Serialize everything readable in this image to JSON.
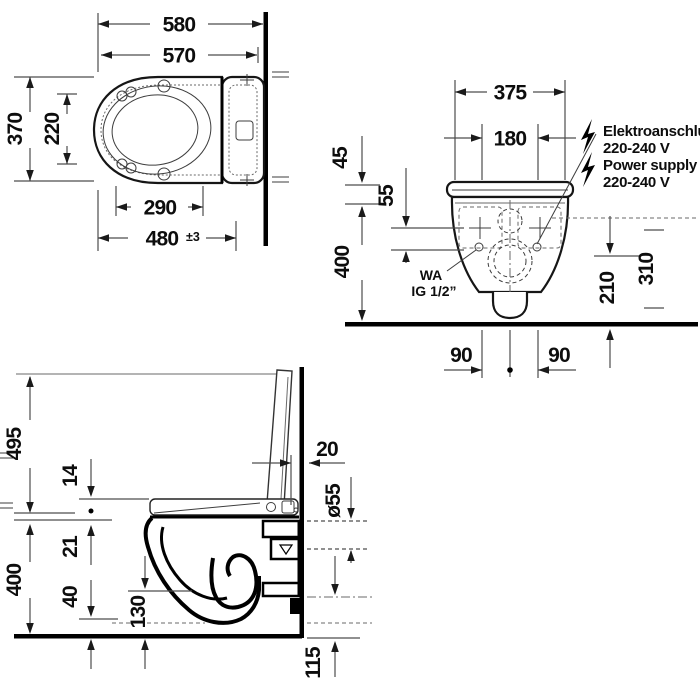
{
  "top_view": {
    "overall_width": "580",
    "bowl_width": "570",
    "depth": "370",
    "inner_depth": "220",
    "seat_length": "290",
    "projection": "480",
    "projection_tolerance": "±3"
  },
  "front_view": {
    "width": "375",
    "bolt_spacing": "180",
    "offset_45": "45",
    "offset_55": "55",
    "rim_height": "400",
    "height_210": "210",
    "height_310": "310",
    "bolt_left": "90",
    "bolt_right": "90",
    "water_connection_line1": "WA",
    "water_connection_line2": "IG 1/2”",
    "electrical_label": "Elektroanschluss",
    "electrical_voltage": "220-240 V",
    "power_label": "Power supply",
    "power_voltage": "220-240 V"
  },
  "side_view": {
    "height_495": "495",
    "height_400": "400",
    "seat_14": "14",
    "seat_21": "21",
    "clearance_40": "40",
    "bowl_130": "130",
    "wall_gap_20": "20",
    "pipe_diameter": "ø55",
    "offset_115": "115"
  }
}
